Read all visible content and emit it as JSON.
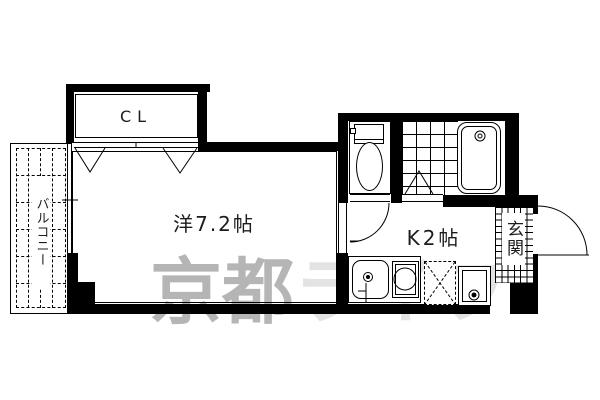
{
  "plan": {
    "closet_label": "CL",
    "main_room_label": "洋7.2帖",
    "kitchen_label": "K2帖",
    "balcony_label": "バルコニー",
    "entrance_label": "玄関"
  },
  "watermark": {
    "primary": "京都",
    "secondary": "ライフ",
    "primary_color": "#b5b5b5",
    "secondary_color": "#e3e3e3"
  },
  "colors": {
    "wall": "#000000",
    "line": "#000000",
    "label": "#1c1c1c",
    "background": "#ffffff"
  }
}
